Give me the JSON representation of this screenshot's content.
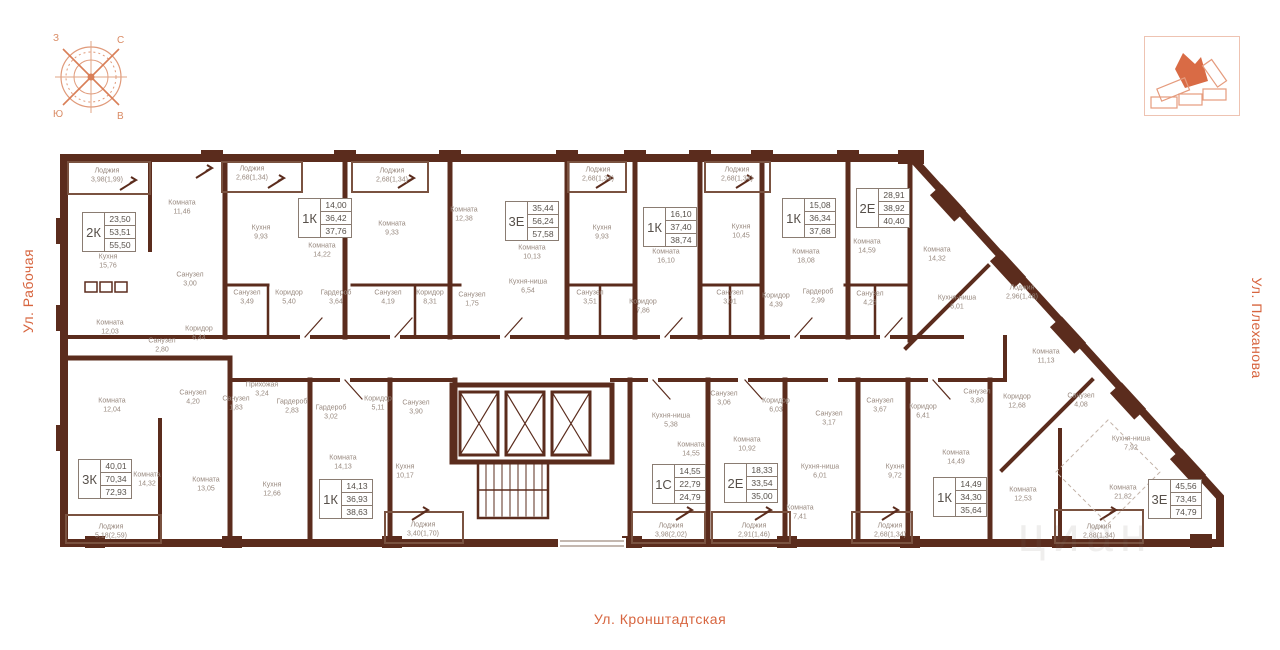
{
  "streets": {
    "left": "Ул. Рабочая",
    "right": "Ул. Плеханова",
    "bottom": "Ул. Кронштадтская"
  },
  "compass": {
    "nw": "З",
    "ne": "С",
    "sw": "Ю",
    "se": "В"
  },
  "watermark": "циан",
  "apartments": [
    {
      "t": "2К",
      "a1": "23,50",
      "a2": "53,51",
      "a3": "55,50",
      "x": 82,
      "y": 212
    },
    {
      "t": "1К",
      "a1": "14,00",
      "a2": "36,42",
      "a3": "37,76",
      "x": 298,
      "y": 198
    },
    {
      "t": "3Е",
      "a1": "35,44",
      "a2": "56,24",
      "a3": "57,58",
      "x": 505,
      "y": 201
    },
    {
      "t": "1К",
      "a1": "16,10",
      "a2": "37,40",
      "a3": "38,74",
      "x": 643,
      "y": 207
    },
    {
      "t": "1К",
      "a1": "15,08",
      "a2": "36,34",
      "a3": "37,68",
      "x": 782,
      "y": 198
    },
    {
      "t": "2Е",
      "a1": "28,91",
      "a2": "38,92",
      "a3": "40,40",
      "x": 856,
      "y": 188
    },
    {
      "t": "3К",
      "a1": "40,01",
      "a2": "70,34",
      "a3": "72,93",
      "x": 78,
      "y": 459
    },
    {
      "t": "1К",
      "a1": "14,13",
      "a2": "36,93",
      "a3": "38,63",
      "x": 319,
      "y": 479
    },
    {
      "t": "1С",
      "a1": "14,55",
      "a2": "22,79",
      "a3": "24,79",
      "x": 652,
      "y": 464
    },
    {
      "t": "2Е",
      "a1": "18,33",
      "a2": "33,54",
      "a3": "35,00",
      "x": 724,
      "y": 463
    },
    {
      "t": "1К",
      "a1": "14,49",
      "a2": "34,30",
      "a3": "35,64",
      "x": 933,
      "y": 477
    },
    {
      "t": "3Е",
      "a1": "45,56",
      "a2": "73,45",
      "a3": "74,79",
      "x": 1148,
      "y": 479
    }
  ],
  "rooms": [
    {
      "n": "Лоджия",
      "a": "3,98(1,99)",
      "x": 107,
      "y": 176
    },
    {
      "n": "Комната",
      "a": "11,46",
      "x": 182,
      "y": 208
    },
    {
      "n": "Кухня",
      "a": "15,76",
      "x": 108,
      "y": 262
    },
    {
      "n": "Комната",
      "a": "12,03",
      "x": 110,
      "y": 328
    },
    {
      "n": "Санузел",
      "a": "3,00",
      "x": 190,
      "y": 280
    },
    {
      "n": "Санузел",
      "a": "2,80",
      "x": 162,
      "y": 346
    },
    {
      "n": "Коридор",
      "a": "6,44",
      "x": 199,
      "y": 334
    },
    {
      "n": "Лоджия",
      "a": "2,68(1,34)",
      "x": 252,
      "y": 174
    },
    {
      "n": "Кухня",
      "a": "9,93",
      "x": 261,
      "y": 233
    },
    {
      "n": "Комната",
      "a": "14,22",
      "x": 322,
      "y": 251
    },
    {
      "n": "Санузел",
      "a": "3,49",
      "x": 247,
      "y": 298
    },
    {
      "n": "Коридор",
      "a": "5,40",
      "x": 289,
      "y": 298
    },
    {
      "n": "Гардероб",
      "a": "3,64",
      "x": 336,
      "y": 298
    },
    {
      "n": "Лоджия",
      "a": "2,68(1,34)",
      "x": 392,
      "y": 176
    },
    {
      "n": "Комната",
      "a": "9,33",
      "x": 392,
      "y": 229
    },
    {
      "n": "Комната",
      "a": "12,38",
      "x": 464,
      "y": 215
    },
    {
      "n": "Санузел",
      "a": "4,19",
      "x": 388,
      "y": 298
    },
    {
      "n": "Коридор",
      "a": "8,31",
      "x": 430,
      "y": 298
    },
    {
      "n": "Санузел",
      "a": "1,75",
      "x": 472,
      "y": 300
    },
    {
      "n": "Лоджия",
      "a": "2,68(1,34)",
      "x": 598,
      "y": 175
    },
    {
      "n": "Кухня",
      "a": "9,93",
      "x": 602,
      "y": 233
    },
    {
      "n": "Комната",
      "a": "10,13",
      "x": 532,
      "y": 253
    },
    {
      "n": "Кухня-ниша",
      "a": "6,54",
      "x": 528,
      "y": 287
    },
    {
      "n": "Санузел",
      "a": "3,51",
      "x": 590,
      "y": 298
    },
    {
      "n": "Коридор",
      "a": "7,86",
      "x": 643,
      "y": 307
    },
    {
      "n": "Комната",
      "a": "16,10",
      "x": 666,
      "y": 257
    },
    {
      "n": "Кухня",
      "a": "10,45",
      "x": 741,
      "y": 232
    },
    {
      "n": "Лоджия",
      "a": "2,68(1,34)",
      "x": 737,
      "y": 175
    },
    {
      "n": "Санузел",
      "a": "3,91",
      "x": 730,
      "y": 298
    },
    {
      "n": "Коридор",
      "a": "4,39",
      "x": 776,
      "y": 301
    },
    {
      "n": "Комната",
      "a": "18,08",
      "x": 806,
      "y": 257
    },
    {
      "n": "Гардероб",
      "a": "2,99",
      "x": 818,
      "y": 297
    },
    {
      "n": "Санузел",
      "a": "4,28",
      "x": 870,
      "y": 299
    },
    {
      "n": "Комната",
      "a": "14,59",
      "x": 867,
      "y": 247
    },
    {
      "n": "Комната",
      "a": "14,32",
      "x": 937,
      "y": 255
    },
    {
      "n": "Кухня-ниша",
      "a": "6,01",
      "x": 957,
      "y": 303
    },
    {
      "n": "Лоджия",
      "a": "2,96(1,48)",
      "x": 1022,
      "y": 293
    },
    {
      "n": "Комната",
      "a": "11,13",
      "x": 1046,
      "y": 357
    },
    {
      "n": "Коридор",
      "a": "12,68",
      "x": 1017,
      "y": 402
    },
    {
      "n": "Санузел",
      "a": "4,08",
      "x": 1081,
      "y": 401
    },
    {
      "n": "Кухня-ниша",
      "a": "7,92",
      "x": 1131,
      "y": 444
    },
    {
      "n": "Комната",
      "a": "12,04",
      "x": 112,
      "y": 406
    },
    {
      "n": "Комната",
      "a": "14,32",
      "x": 147,
      "y": 480
    },
    {
      "n": "Комната",
      "a": "13,05",
      "x": 206,
      "y": 485
    },
    {
      "n": "Кухня",
      "a": "12,66",
      "x": 272,
      "y": 490
    },
    {
      "n": "Лоджия",
      "a": "5,18(2,59)",
      "x": 111,
      "y": 532
    },
    {
      "n": "Санузел",
      "a": "4,20",
      "x": 193,
      "y": 398
    },
    {
      "n": "Санузел",
      "a": "1,83",
      "x": 236,
      "y": 404
    },
    {
      "n": "Прихожая",
      "a": "3,24",
      "x": 262,
      "y": 390
    },
    {
      "n": "Гардероб",
      "a": "2,83",
      "x": 292,
      "y": 407
    },
    {
      "n": "Гардероб",
      "a": "3,02",
      "x": 331,
      "y": 413
    },
    {
      "n": "Коридор",
      "a": "5,11",
      "x": 378,
      "y": 404
    },
    {
      "n": "Санузел",
      "a": "3,90",
      "x": 416,
      "y": 408
    },
    {
      "n": "Комната",
      "a": "14,13",
      "x": 343,
      "y": 463
    },
    {
      "n": "Кухня",
      "a": "10,17",
      "x": 405,
      "y": 472
    },
    {
      "n": "Лоджия",
      "a": "3,40(1,70)",
      "x": 423,
      "y": 530
    },
    {
      "n": "Кухня-ниша",
      "a": "5,38",
      "x": 671,
      "y": 421
    },
    {
      "n": "Комната",
      "a": "14,55",
      "x": 691,
      "y": 450
    },
    {
      "n": "Санузел",
      "a": "3,06",
      "x": 724,
      "y": 399
    },
    {
      "n": "Коридор",
      "a": "6,03",
      "x": 776,
      "y": 406
    },
    {
      "n": "Лоджия",
      "a": "3,98(2,02)",
      "x": 671,
      "y": 531
    },
    {
      "n": "Комната",
      "a": "10,92",
      "x": 747,
      "y": 445
    },
    {
      "n": "Санузел",
      "a": "3,17",
      "x": 829,
      "y": 419
    },
    {
      "n": "Кухня-ниша",
      "a": "6,01",
      "x": 820,
      "y": 472
    },
    {
      "n": "Комната",
      "a": "7,41",
      "x": 800,
      "y": 513
    },
    {
      "n": "Лоджия",
      "a": "2,91(1,46)",
      "x": 754,
      "y": 531
    },
    {
      "n": "Санузел",
      "a": "3,67",
      "x": 880,
      "y": 406
    },
    {
      "n": "Коридор",
      "a": "6,41",
      "x": 923,
      "y": 412
    },
    {
      "n": "Кухня",
      "a": "9,72",
      "x": 895,
      "y": 472
    },
    {
      "n": "Комната",
      "a": "14,49",
      "x": 956,
      "y": 458
    },
    {
      "n": "Лоджия",
      "a": "2,68(1,34)",
      "x": 890,
      "y": 531
    },
    {
      "n": "Санузел",
      "a": "3,80",
      "x": 977,
      "y": 397
    },
    {
      "n": "Комната",
      "a": "12,53",
      "x": 1023,
      "y": 495
    },
    {
      "n": "Комната",
      "a": "21,82",
      "x": 1123,
      "y": 493
    },
    {
      "n": "Лоджия",
      "a": "2,88(1,34)",
      "x": 1099,
      "y": 532
    }
  ]
}
